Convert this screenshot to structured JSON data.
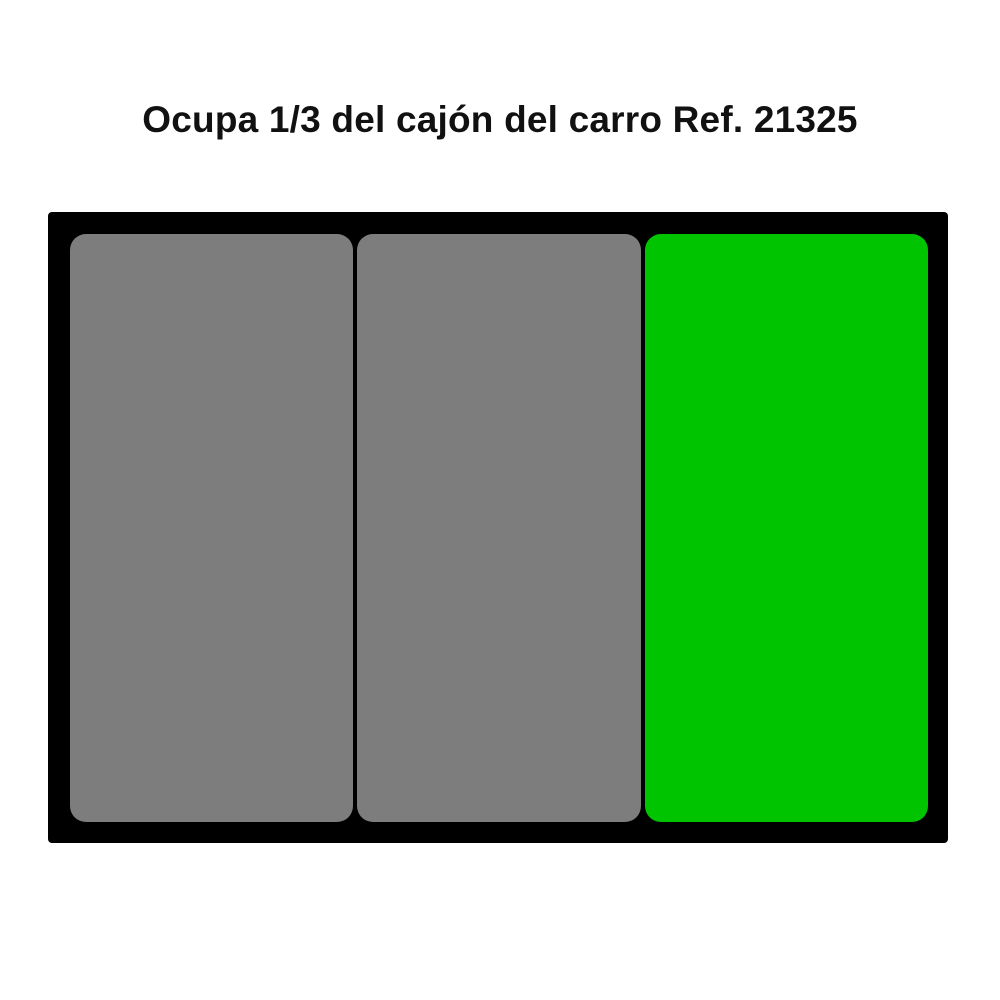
{
  "title": "Ocupa 1/3 del cajón del carro Ref. 21325",
  "colors": {
    "background": "#FFFFFF",
    "title_text": "#111111",
    "drawer_frame": "#000000",
    "slot_empty": "#7D7D7D",
    "slot_highlight": "#00C400"
  },
  "drawer": {
    "description": "drawer-top-view-divided-in-thirds",
    "slots": [
      {
        "name": "drawer-slot-1",
        "state": "empty"
      },
      {
        "name": "drawer-slot-2",
        "state": "empty"
      },
      {
        "name": "drawer-slot-3",
        "state": "highlighted"
      }
    ]
  }
}
